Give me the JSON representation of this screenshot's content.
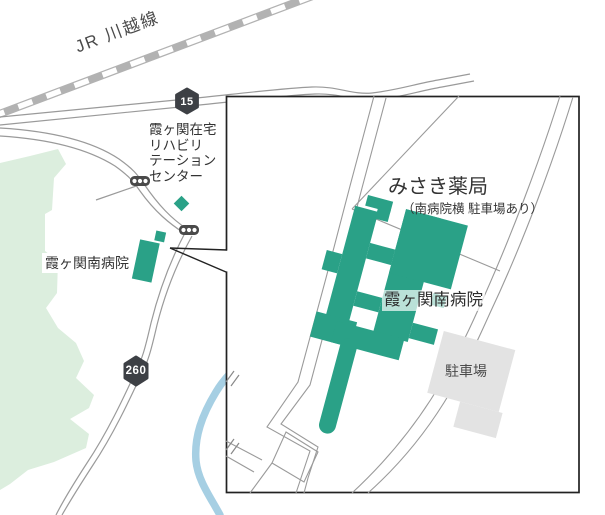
{
  "map": {
    "railway_label": "JR 川越線",
    "route_15": "15",
    "route_260": "260",
    "rehab_center_label": "霞ヶ関在宅\nリハビリ\nテーション\nセンター",
    "hospital_label": "霞ヶ関南病院"
  },
  "inset": {
    "pharmacy_name": "みさき薬局",
    "pharmacy_note": "（南病院横 駐車場あり）",
    "hospital_name": "霞ヶ関南病院",
    "parking_label": "駐車場"
  },
  "colors": {
    "building_green": "#2aa187",
    "park_green": "#dceede",
    "parking_gray": "#e3e3e3",
    "river_blue": "#a6cfe3",
    "road_gray": "#9a9a9a",
    "railway_gray": "#b2b2b2",
    "badge_dark": "#3d4045",
    "outline_black": "#222222"
  }
}
